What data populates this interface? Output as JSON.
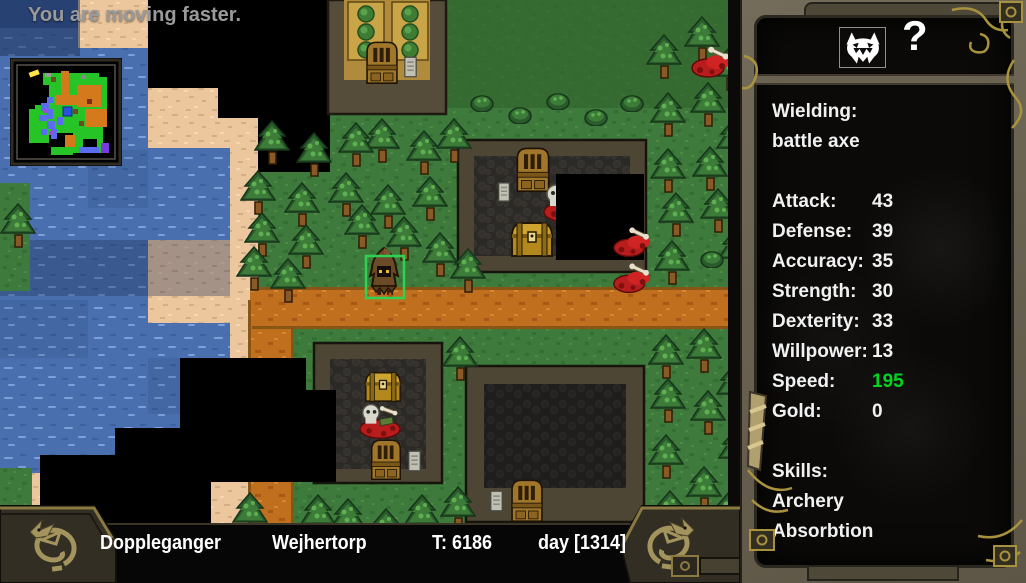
{
  "message": {
    "text": "You are moving faster."
  },
  "status_bar": {
    "character": "Doppleganger",
    "location": "Wejhertorp",
    "turn": "T: 6186",
    "day": "day [1314]"
  },
  "panel": {
    "portrait_icon": "demon-face-icon",
    "help_glyph": "?",
    "wielding": {
      "label": "Wielding:",
      "value": "battle axe"
    },
    "stats": [
      {
        "label": "Attack:",
        "value": "43",
        "color": "#f1f1f1"
      },
      {
        "label": "Defense:",
        "value": "39",
        "color": "#f1f1f1"
      },
      {
        "label": "Accuracy:",
        "value": "35",
        "color": "#f1f1f1"
      },
      {
        "label": "Strength:",
        "value": "30",
        "color": "#f1f1f1"
      },
      {
        "label": "Dexterity:",
        "value": "33",
        "color": "#f1f1f1"
      },
      {
        "label": "Willpower:",
        "value": "13",
        "color": "#f1f1f1"
      },
      {
        "label": "Speed:",
        "value": "195",
        "color": "#00d422"
      },
      {
        "label": "Gold:",
        "value": "0",
        "color": "#f1f1f1"
      }
    ],
    "skills": {
      "label": "Skills:",
      "items": [
        "Archery",
        "Absorbtion"
      ]
    }
  },
  "colors": {
    "speed_highlight": "#00d422",
    "panel_frame": "#6b6352",
    "gold_trim": "#a8923e",
    "selection_box": "#2ed152",
    "road": "#c06f1e",
    "water": "#4a6fae",
    "grass": "#3d7a3b",
    "sand": "#ecc79e"
  }
}
